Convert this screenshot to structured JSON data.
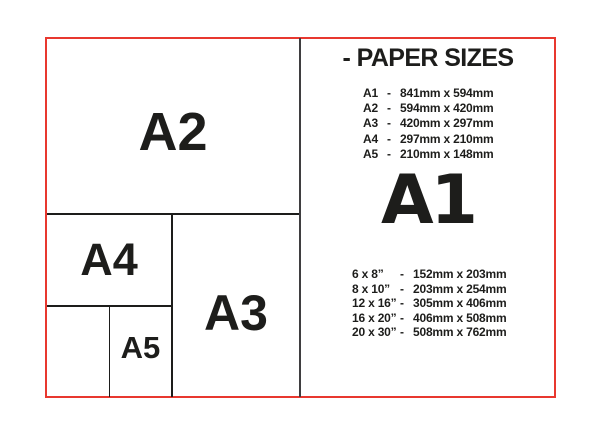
{
  "frame": {
    "border_color": "#e8382f",
    "line_color": "#1d1d1b",
    "divider_color": "#3f3e40"
  },
  "diagram": {
    "a2_label": "A2",
    "a4_label": "A4",
    "a3_label": "A3",
    "a5_label": "A5"
  },
  "info": {
    "title": "- PAPER SIZES",
    "separator": "-",
    "featured_label": "A1",
    "a_series": [
      {
        "name": "A1",
        "size": "841mm x 594mm"
      },
      {
        "name": "A2",
        "size": "594mm x 420mm"
      },
      {
        "name": "A3",
        "size": "420mm x 297mm"
      },
      {
        "name": "A4",
        "size": "297mm x 210mm"
      },
      {
        "name": "A5",
        "size": "210mm x 148mm"
      }
    ],
    "inch_series": [
      {
        "name": "6 x 8”",
        "size": "152mm x 203mm"
      },
      {
        "name": "8 x 10”",
        "size": "203mm x 254mm"
      },
      {
        "name": "12 x 16”",
        "size": "305mm x 406mm"
      },
      {
        "name": "16 x 20”",
        "size": "406mm x 508mm"
      },
      {
        "name": "20 x 30”",
        "size": "508mm x 762mm"
      }
    ]
  }
}
